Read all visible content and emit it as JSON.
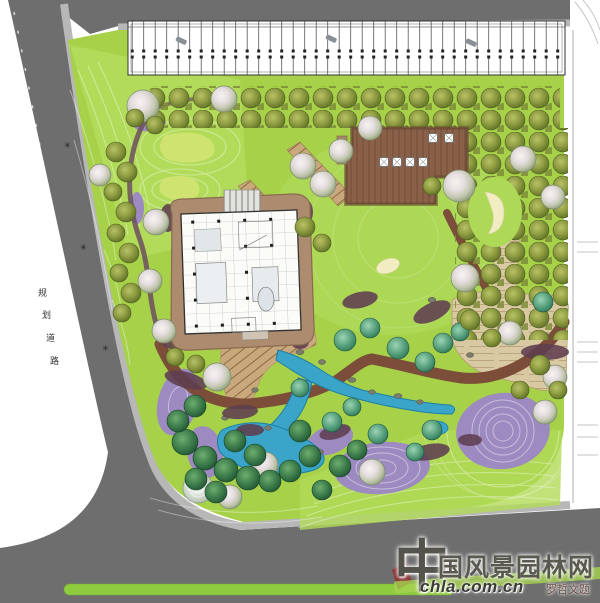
{
  "palette": {
    "road": "#6e6e6e",
    "sidewalk": "#b7b7b7",
    "lawn": "#a6d149",
    "lawn_light": "#b5dd60",
    "water": "#3aa5c8",
    "deck_wood": "#8a6148",
    "loop_path": "#7c4e3a",
    "stone_plaza": "#d9c9a3",
    "purple_planting": "#9c8ac0",
    "building_pad": "#ac8b6e",
    "sand": "#f1ecc2",
    "median_green": "#8fcb3e"
  },
  "watermark": {
    "brand_initial": "中",
    "brand_rest": "国风景园林网",
    "url": "chla.com.cn",
    "inscription": "罗哲文题",
    "accent_green": "#a5d14f",
    "accent_red": "#8e2f2f"
  },
  "annotations": {
    "road_label_chars": [
      "规",
      "划",
      "道",
      "路"
    ],
    "marker_glyph": "✳"
  }
}
